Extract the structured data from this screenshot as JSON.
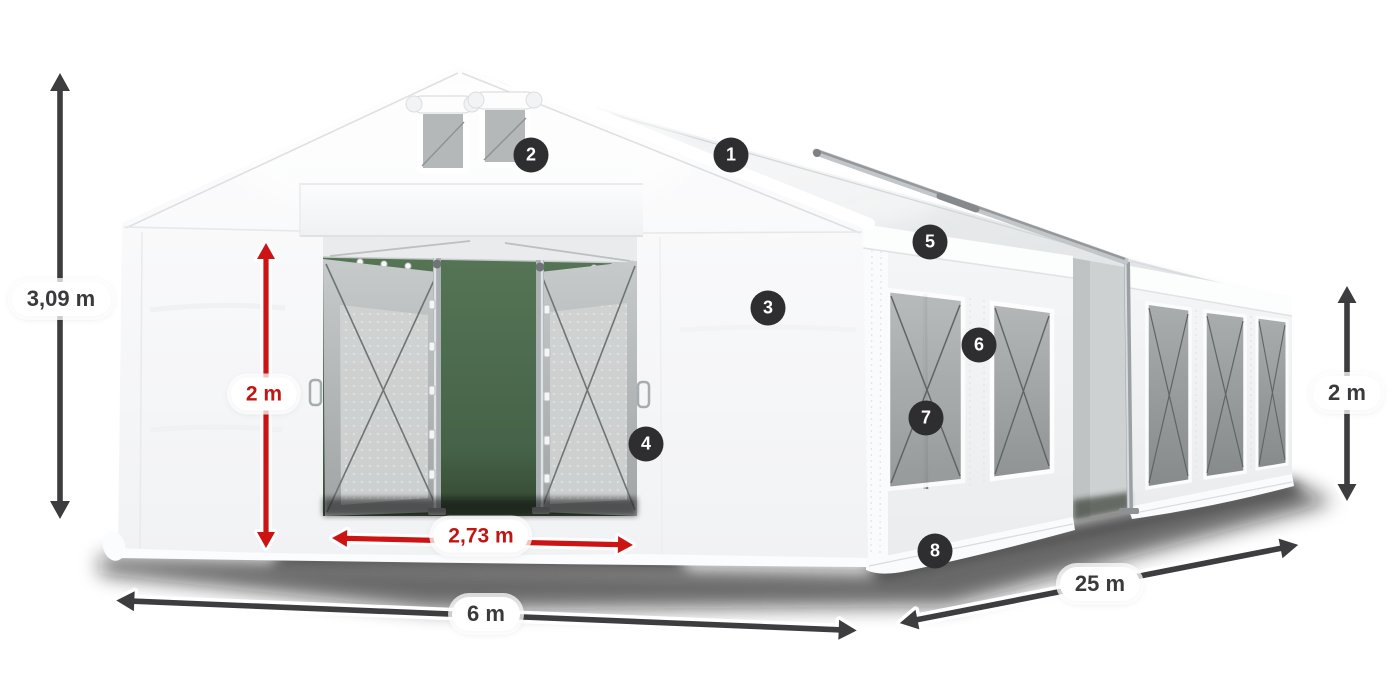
{
  "diagram": {
    "subject": "marquee-tent-dimension-diagram",
    "colors": {
      "background": "#ffffff",
      "tent_white": "#f6f7f8",
      "mesh_gray": "#a9adae",
      "doorway_backdrop_green": "#4a6b4c",
      "arrow_dark": "#3d3d3f",
      "arrow_red": "#cc1414",
      "pill_bg": "#ffffff",
      "pill_text_dark": "#3a3a3c",
      "pill_text_red": "#c31414",
      "badge_bg": "#2e2d2f",
      "badge_text": "#ffffff"
    },
    "dimensions": [
      {
        "id": "total-height",
        "label": "3,09 m",
        "style": "dark",
        "orientation": "vertical",
        "position": "left-of-tent"
      },
      {
        "id": "door-height",
        "label": "2 m",
        "style": "red",
        "orientation": "vertical",
        "position": "front-left-wall"
      },
      {
        "id": "door-width",
        "label": "2,73 m",
        "style": "red",
        "orientation": "horizontal",
        "position": "entrance-ground"
      },
      {
        "id": "front-width",
        "label": "6 m",
        "style": "dark",
        "orientation": "horizontal",
        "position": "below-front"
      },
      {
        "id": "side-length",
        "label": "25 m",
        "style": "dark",
        "orientation": "diagonal",
        "position": "below-side"
      },
      {
        "id": "side-height",
        "label": "2 m",
        "style": "dark",
        "orientation": "vertical",
        "position": "right-of-tent"
      }
    ],
    "callouts": [
      "1",
      "2",
      "3",
      "4",
      "5",
      "6",
      "7",
      "8"
    ]
  }
}
